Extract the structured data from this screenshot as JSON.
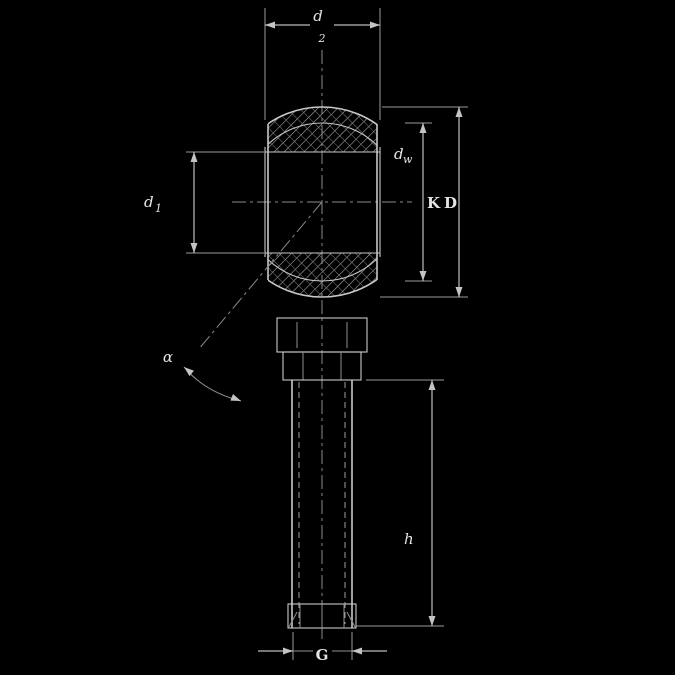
{
  "drawing": {
    "type": "rod-end-spherical-bearing-cross-section",
    "colors": {
      "background": "#000000",
      "line": "#c9c9c9",
      "text": "#e4e4e4"
    },
    "labels": {
      "top_dim": {
        "base": "d",
        "sub": "2"
      },
      "bore_dim": {
        "base": "d",
        "sub": "1"
      },
      "race_dim": {
        "base": "d",
        "sub": "w"
      },
      "sphere_dim": {
        "base": "K",
        "sub": ""
      },
      "head_dim": {
        "base": "D",
        "sub": ""
      },
      "thread_length": {
        "base": "h",
        "sub": ""
      },
      "thread_dim": {
        "base": "G",
        "sub": ""
      },
      "tilt_angle": {
        "base": "α",
        "sub": ""
      }
    }
  }
}
